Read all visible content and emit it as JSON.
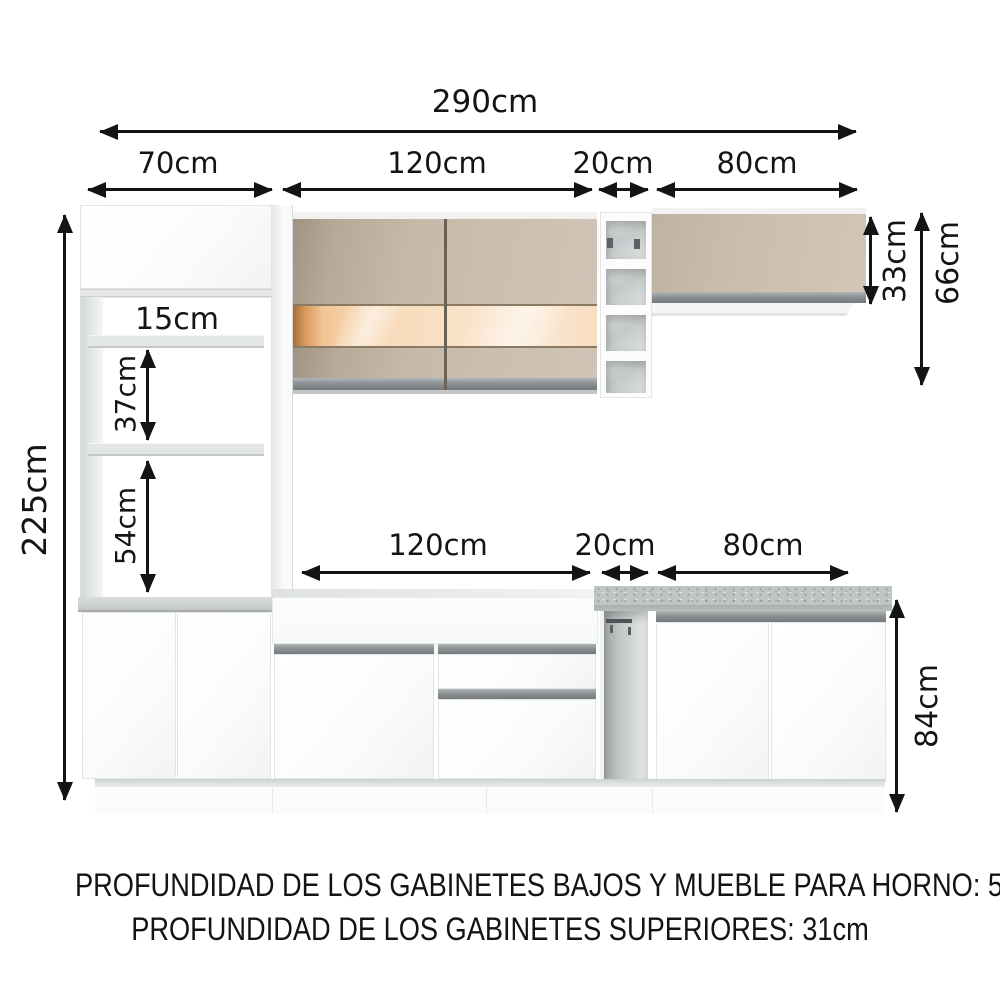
{
  "dimensions": {
    "total_width": "290cm",
    "top_widths": [
      "70cm",
      "120cm",
      "20cm",
      "80cm"
    ],
    "total_height": "225cm",
    "hutch_openings": [
      "15cm",
      "37cm",
      "54cm"
    ],
    "wall_cabinet_height": "33cm",
    "upper_section_height": "66cm",
    "base_widths": [
      "120cm",
      "20cm",
      "80cm"
    ],
    "base_height": "84cm"
  },
  "footer": {
    "line1": "PROFUNDIDAD DE LOS GABINETES BAJOS Y MUEBLE PARA HORNO: 52cm",
    "line2": "PROFUNDIDAD DE LOS GABINETES SUPERIORES: 31cm"
  },
  "colors": {
    "dimension_ink": "#141414",
    "cabinet_white": "#fdfdfd",
    "door_beige": "#c7baa9",
    "glass_peach": "#f8ddc0",
    "handle_gray": "#8e9496",
    "countertop_gray": "#c5c9c9",
    "granite_gray": "#bfc5c1"
  }
}
